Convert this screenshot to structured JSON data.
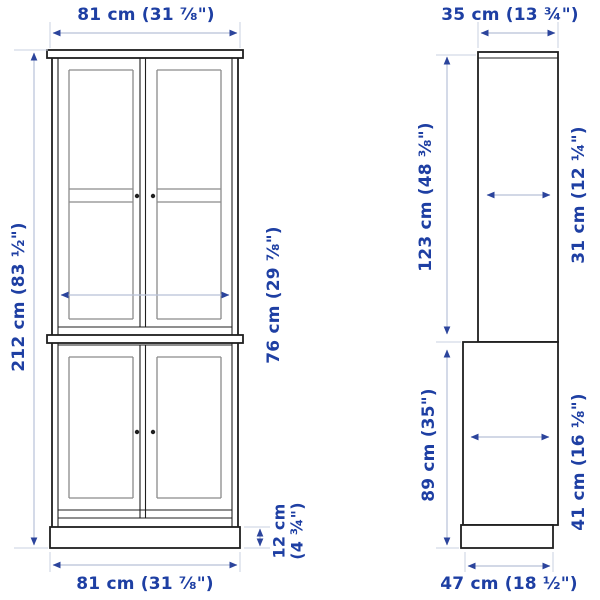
{
  "colors": {
    "background": "#ffffff",
    "text_blue": "#1e3fa3",
    "arrow_blue": "#2b449c",
    "shaft": "#b8c1d8",
    "tick": "#c9d0e2",
    "outline": "#1f1f1f",
    "detail_gray": "#8a8a8a",
    "back_gray": "#8f8f8f"
  },
  "front_view": {
    "width_top": "81 cm (31 ⅞\")",
    "overall_height": "212 cm (83 ½\")",
    "interior_width": "76 cm (29 ⅞\")",
    "plinth_height_line1": "12 cm",
    "plinth_height_line2": "(4 ¾\")",
    "width_bottom": "81 cm (31 ⅞\")"
  },
  "side_view": {
    "depth_top": "35 cm (13 ¾\")",
    "upper_section_height": "123 cm (48 ⅜\")",
    "upper_interior_depth": "31 cm (12 ¼\")",
    "lower_section_height": "89 cm (35\")",
    "lower_interior_depth": "41 cm (16 ⅛\")",
    "base_depth": "47 cm (18 ½\")"
  }
}
